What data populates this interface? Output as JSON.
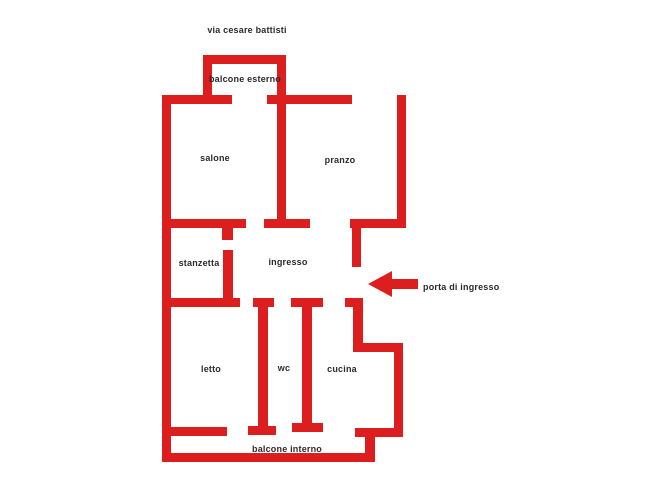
{
  "canvas": {
    "width": 648,
    "height": 492,
    "background": "#ffffff"
  },
  "colors": {
    "wall": "#dd1e1e",
    "text": "#2b2b2b"
  },
  "street_label": {
    "text": "via cesare battisti",
    "cx": 247,
    "cy": 30
  },
  "floorplan": {
    "walls": [
      {
        "name": "balcone-esterno-top",
        "x": 203,
        "y": 55,
        "w": 83,
        "h": 9
      },
      {
        "name": "balcone-esterno-left",
        "x": 203,
        "y": 55,
        "w": 9,
        "h": 49
      },
      {
        "name": "salone-pranzo-divider",
        "x": 277,
        "y": 55,
        "w": 9,
        "h": 173
      },
      {
        "name": "top-wall-left-segment",
        "x": 162,
        "y": 95,
        "w": 70,
        "h": 9
      },
      {
        "name": "top-wall-right-segment",
        "x": 267,
        "y": 95,
        "w": 85,
        "h": 9
      },
      {
        "name": "left-outer-wall",
        "x": 162,
        "y": 95,
        "w": 9,
        "h": 367
      },
      {
        "name": "right-outer-wall-top",
        "x": 397,
        "y": 95,
        "w": 9,
        "h": 133
      },
      {
        "name": "ingresso-right-horizontal",
        "x": 350,
        "y": 219,
        "w": 56,
        "h": 9
      },
      {
        "name": "ingresso-right-vertical",
        "x": 352,
        "y": 228,
        "w": 9,
        "h": 39
      },
      {
        "name": "stanzetta-top-wall",
        "x": 171,
        "y": 219,
        "w": 75,
        "h": 9
      },
      {
        "name": "stanzetta-door-jamb",
        "x": 222,
        "y": 228,
        "w": 11,
        "h": 12
      },
      {
        "name": "stanzetta-right-wall",
        "x": 223,
        "y": 250,
        "w": 10,
        "h": 57
      },
      {
        "name": "pranzo-bottom-cap",
        "x": 264,
        "y": 219,
        "w": 46,
        "h": 9
      },
      {
        "name": "letto-top-wall",
        "x": 171,
        "y": 298,
        "w": 69,
        "h": 9
      },
      {
        "name": "wc-left-wall-top-cap",
        "x": 253,
        "y": 298,
        "w": 21,
        "h": 9
      },
      {
        "name": "wc-left-wall",
        "x": 258,
        "y": 298,
        "w": 10,
        "h": 137
      },
      {
        "name": "wc-left-wall-bottom-cap",
        "x": 248,
        "y": 426,
        "w": 28,
        "h": 9
      },
      {
        "name": "wc-right-wall-top-cap",
        "x": 291,
        "y": 298,
        "w": 32,
        "h": 9
      },
      {
        "name": "wc-right-wall",
        "x": 302,
        "y": 298,
        "w": 10,
        "h": 134
      },
      {
        "name": "wc-right-wall-bottom-cap",
        "x": 292,
        "y": 423,
        "w": 31,
        "h": 9
      },
      {
        "name": "letto-bottom-wall",
        "x": 171,
        "y": 427,
        "w": 56,
        "h": 9
      },
      {
        "name": "cucina-left-top-stub",
        "x": 345,
        "y": 298,
        "w": 18,
        "h": 9
      },
      {
        "name": "cucina-left-wall",
        "x": 353,
        "y": 298,
        "w": 10,
        "h": 54
      },
      {
        "name": "cucina-top-right-wall",
        "x": 353,
        "y": 343,
        "w": 50,
        "h": 9
      },
      {
        "name": "cucina-right-wall",
        "x": 394,
        "y": 343,
        "w": 9,
        "h": 94
      },
      {
        "name": "cucina-bottom-wall",
        "x": 355,
        "y": 428,
        "w": 48,
        "h": 9
      },
      {
        "name": "balcone-interno-right",
        "x": 365,
        "y": 437,
        "w": 10,
        "h": 25
      },
      {
        "name": "balcone-interno-bottom",
        "x": 162,
        "y": 453,
        "w": 213,
        "h": 9
      }
    ],
    "room_labels": [
      {
        "name": "balcone-esterno",
        "text": "balcone esterno",
        "cx": 245,
        "cy": 79
      },
      {
        "name": "salone",
        "text": "salone",
        "cx": 215,
        "cy": 158
      },
      {
        "name": "pranzo",
        "text": "pranzo",
        "cx": 340,
        "cy": 160
      },
      {
        "name": "stanzetta",
        "text": "stanzetta",
        "cx": 199,
        "cy": 263
      },
      {
        "name": "ingresso",
        "text": "ingresso",
        "cx": 288,
        "cy": 262
      },
      {
        "name": "letto",
        "text": "letto",
        "cx": 211,
        "cy": 369
      },
      {
        "name": "wc",
        "text": "wc",
        "cx": 284,
        "cy": 368
      },
      {
        "name": "cucina",
        "text": "cucina",
        "cx": 342,
        "cy": 369
      },
      {
        "name": "balcone-interno",
        "text": "balcone interno",
        "cx": 287,
        "cy": 449
      }
    ],
    "entrance": {
      "label": "porta di ingresso",
      "label_x": 423,
      "label_cy": 287,
      "arrow": {
        "x": 367,
        "y": 270,
        "width": 52,
        "height": 28,
        "direction": "left"
      }
    }
  }
}
